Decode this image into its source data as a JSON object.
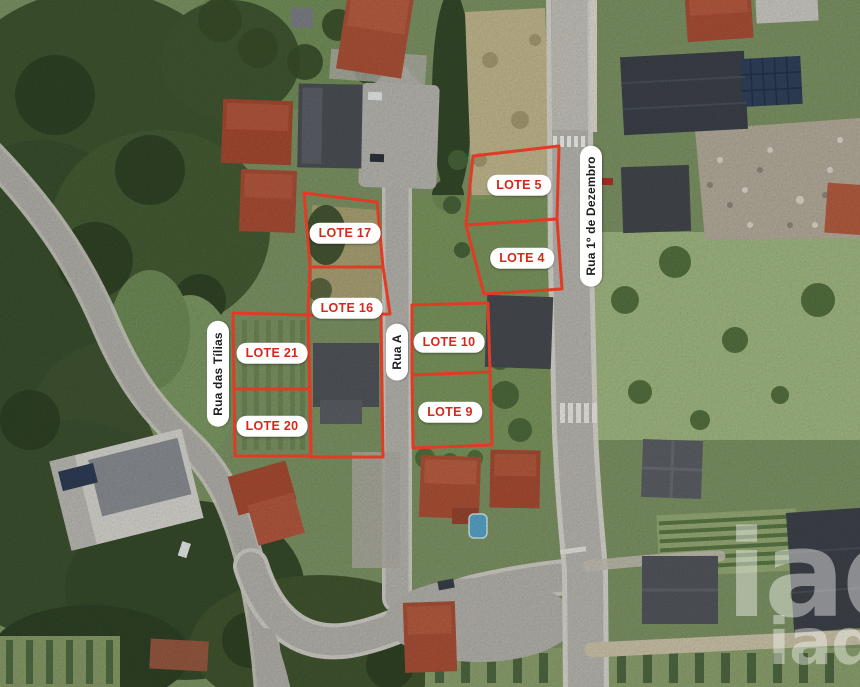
{
  "map": {
    "type": "aerial-lot-plan",
    "outline_color": "#e23b25",
    "lot_label_text_color": "#d5281b",
    "label_bg_color": "#ffffff",
    "street_text_color": "#1d1d1d"
  },
  "lots": [
    {
      "label": "LOTE 5",
      "points": "473,156 559,146 557,219 466,225",
      "x": 519,
      "y": 185
    },
    {
      "label": "LOTE 4",
      "points": "466,225 557,219 562,289 484,294",
      "x": 522,
      "y": 258
    },
    {
      "label": "LOTE 17",
      "points": "304,193 377,202 383,267 310,267",
      "x": 345,
      "y": 233
    },
    {
      "label": "LOTE 16",
      "points": "310,267 383,267 390,314 308,315",
      "x": 347,
      "y": 308
    },
    {
      "label": "LOTE 21",
      "points": "233,313 308,315 310,389 234,389",
      "x": 272,
      "y": 353
    },
    {
      "label": "LOTE 20",
      "points": "234,389 310,389 311,456 235,456",
      "x": 272,
      "y": 426
    },
    {
      "label": "LOTE 10",
      "points": "412,305 488,303 490,372 412,375",
      "x": 449,
      "y": 342
    },
    {
      "label": "LOTE 9",
      "points": "412,375 490,372 492,445 413,448",
      "x": 450,
      "y": 412
    }
  ],
  "extra_outlines": [
    {
      "name": "house-parcel",
      "points": "308,315 381,315 383,457 311,457"
    }
  ],
  "streets": [
    {
      "label": "Rua das Tílias",
      "x": 218,
      "y": 374
    },
    {
      "label": "Rua A",
      "x": 397,
      "y": 352
    },
    {
      "label": "Rua 1º de Dezembro",
      "x": 591,
      "y": 216
    }
  ],
  "watermark": {
    "brand_large": "iad",
    "brand_small": "iad"
  }
}
